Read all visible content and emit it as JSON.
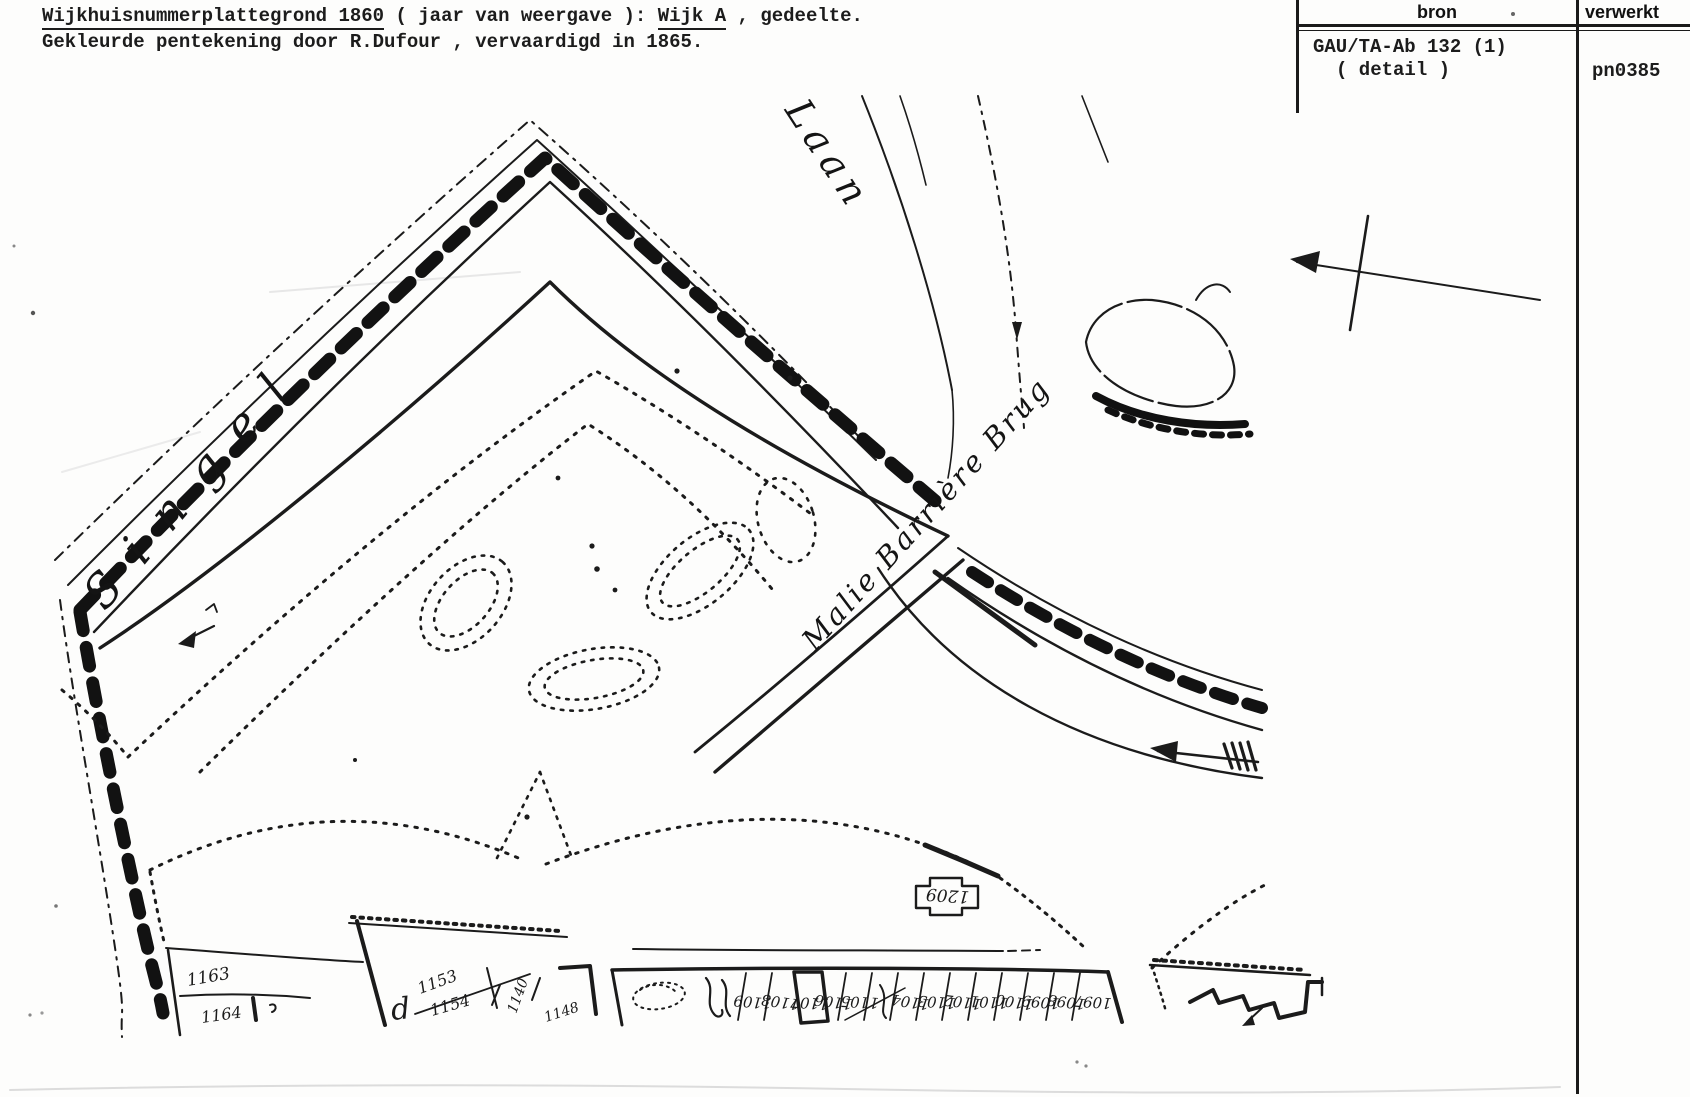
{
  "header": {
    "line1_part1": "Wijkhuisnummerplattegrond 1860",
    "line1_part2": " ( jaar van weergave ): ",
    "line1_part3": "Wijk A",
    "line1_part4": " , gedeelte.",
    "line2": "Gekleurde pentekening door R.Dufour , vervaardigd in 1865."
  },
  "reference_table": {
    "col_bron": "bron",
    "col_verwerkt": "verwerkt",
    "bron_value_line1": "GAU/TA-Ab 132 (1)",
    "bron_value_line2": "( detail )",
    "verwerkt_value": "pn0385"
  },
  "map": {
    "labels": {
      "street_script": "Singel",
      "laan_script": "Laan",
      "bridge_script": "Malie Barrière Brug",
      "cartouche_number": "1209"
    },
    "parcels_left": {
      "n1": "1163",
      "n2": "1164"
    },
    "parcels_mid": {
      "n1": "1153",
      "n2": "1154",
      "n3": "1140",
      "n4": "1148"
    },
    "parcel_numbers_strip": [
      "1109",
      "1108",
      "1107",
      "1106",
      "1105",
      "1104",
      "1103",
      "1102",
      "1101",
      "1100",
      "1099",
      "1098",
      "1097"
    ]
  }
}
